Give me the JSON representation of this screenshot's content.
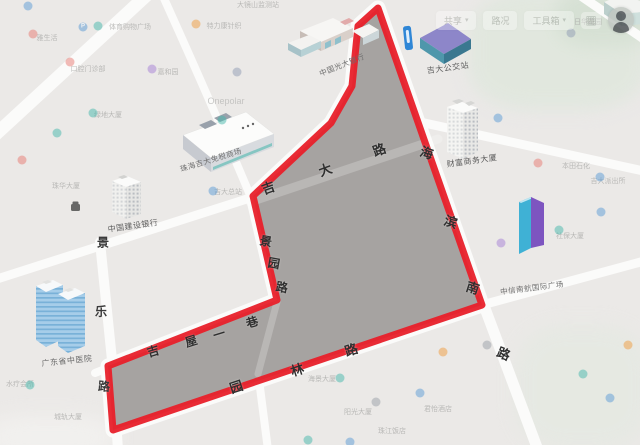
{
  "toolbar": {
    "buttons": [
      {
        "label": "共享",
        "caret": "▾"
      },
      {
        "label": "路况",
        "caret": ""
      },
      {
        "label": "工具箱",
        "caret": "▾"
      }
    ],
    "grid_icon": "▦"
  },
  "map": {
    "background": "#ebe9e7",
    "road_color": "#fbfbfa",
    "boundary_color": "#e8202a",
    "region_fill": "#a6a3a1",
    "boundary_points": "378,8 358,26 352,86 331,123 253,196 277,300 108,366 113,430 482,305",
    "green_patches": [
      {
        "x": 468,
        "y": -10,
        "w": 180,
        "h": 120,
        "c": "#e0e7de",
        "o": 0.9
      },
      {
        "x": 556,
        "y": -12,
        "w": 95,
        "h": 58,
        "c": "#d5e0d3",
        "o": 0.9
      },
      {
        "x": 515,
        "y": 325,
        "w": 135,
        "h": 125,
        "c": "#e5e9e2",
        "o": 0.8
      },
      {
        "x": -15,
        "y": 415,
        "w": 130,
        "h": 45,
        "c": "#f4f3f1",
        "o": 0.7
      }
    ],
    "roads": [
      {
        "d": "M148,-6 L-6,136",
        "w": 13
      },
      {
        "d": "M162,-6 Q210,100 250,195",
        "w": 8
      },
      {
        "d": "M253,197 L-6,280",
        "w": 9
      },
      {
        "d": "M100,242 L112,360 L118,450",
        "w": 10
      },
      {
        "d": "M283,298 L95,373",
        "w": 8
      },
      {
        "d": "M258,372 L268,450",
        "w": 8
      },
      {
        "d": "M482,305 L648,260",
        "w": 9
      },
      {
        "d": "M483,303 L538,450",
        "w": 11
      },
      {
        "d": "M420,122 L648,172",
        "w": 9
      },
      {
        "d": "M578,-6 L648,42",
        "w": 9
      }
    ],
    "interior_roads": [
      {
        "d": "M250,202 L438,139",
        "w": 9
      },
      {
        "d": "M277,302 L258,374",
        "w": 7
      }
    ],
    "streets": [
      {
        "name": "吉大路",
        "size": 13,
        "color": "#2f2f2f",
        "chars": [
          {
            "c": "吉",
            "x": 268,
            "y": 187,
            "r": -20
          },
          {
            "c": "大",
            "x": 325,
            "y": 169,
            "r": -20
          },
          {
            "c": "路",
            "x": 379,
            "y": 149,
            "r": -20
          }
        ]
      },
      {
        "name": "海滨南路",
        "size": 13,
        "color": "#2f2f2f",
        "chars": [
          {
            "c": "海",
            "x": 427,
            "y": 152,
            "r": 18
          },
          {
            "c": "滨",
            "x": 451,
            "y": 221,
            "r": 18
          },
          {
            "c": "南",
            "x": 473,
            "y": 287,
            "r": 18
          },
          {
            "c": "路",
            "x": 504,
            "y": 353,
            "r": 22
          }
        ]
      },
      {
        "name": "景园路",
        "size": 12,
        "color": "#2f2f2f",
        "chars": [
          {
            "c": "景",
            "x": 266,
            "y": 241,
            "r": 10
          },
          {
            "c": "园",
            "x": 274,
            "y": 263,
            "r": 10
          },
          {
            "c": "路",
            "x": 282,
            "y": 287,
            "r": 10
          }
        ]
      },
      {
        "name": "吉屋一巷",
        "size": 12,
        "color": "#2f2f2f",
        "chars": [
          {
            "c": "吉",
            "x": 153,
            "y": 351,
            "r": -17
          },
          {
            "c": "屋",
            "x": 191,
            "y": 341,
            "r": -17
          },
          {
            "c": "一",
            "x": 219,
            "y": 334,
            "r": -17
          },
          {
            "c": "巷",
            "x": 252,
            "y": 322,
            "r": -17
          }
        ]
      },
      {
        "name": "景乐路",
        "size": 12,
        "color": "#3a3a3a",
        "chars": [
          {
            "c": "景",
            "x": 103,
            "y": 242,
            "r": 0
          },
          {
            "c": "乐",
            "x": 101,
            "y": 311,
            "r": 0
          },
          {
            "c": "路",
            "x": 104,
            "y": 386,
            "r": 4
          }
        ]
      },
      {
        "name": "园林路",
        "size": 13,
        "color": "#2f2f2f",
        "chars": [
          {
            "c": "园",
            "x": 236,
            "y": 386,
            "r": -18
          },
          {
            "c": "林",
            "x": 297,
            "y": 369,
            "r": -18
          },
          {
            "c": "路",
            "x": 351,
            "y": 349,
            "r": -18
          }
        ]
      }
    ],
    "poi_labels": [
      {
        "t": "珠海吉大免税商场",
        "x": 211,
        "y": 160,
        "r": -17,
        "s": 7.5,
        "c": "#6e6e6e"
      },
      {
        "t": "中国光大银行",
        "x": 342,
        "y": 65,
        "r": -22,
        "s": 7.5,
        "c": "#6e6e6e"
      },
      {
        "t": "吉大公交站",
        "x": 448,
        "y": 68,
        "r": -8,
        "s": 8,
        "c": "#5f5f5f"
      },
      {
        "t": "财富商务大厦",
        "x": 472,
        "y": 161,
        "r": -8,
        "s": 8,
        "c": "#5a5a5a"
      },
      {
        "t": "中信南航国际广场",
        "x": 532,
        "y": 288,
        "r": -7,
        "s": 7.5,
        "c": "#707070"
      },
      {
        "t": "中国建设银行",
        "x": 133,
        "y": 226,
        "r": -8,
        "s": 8,
        "c": "#5f5f5f"
      },
      {
        "t": "广东省中医院",
        "x": 67,
        "y": 361,
        "r": -6,
        "s": 8,
        "c": "#6a6a6a"
      }
    ],
    "faint_labels": [
      {
        "t": "大镜山监测站",
        "x": 258,
        "y": 5
      },
      {
        "t": "体育购物广场",
        "x": 130,
        "y": 27
      },
      {
        "t": "特力康针织",
        "x": 224,
        "y": 26
      },
      {
        "t": "雅生活",
        "x": 47,
        "y": 38
      },
      {
        "t": "口腔门诊部",
        "x": 88,
        "y": 69
      },
      {
        "t": "嘉和园",
        "x": 168,
        "y": 72
      },
      {
        "t": "绿地大厦",
        "x": 108,
        "y": 115
      },
      {
        "t": "Onepolar",
        "x": 226,
        "y": 101,
        "s": 9,
        "c": "#b8b8b6"
      },
      {
        "t": "珠华大厦",
        "x": 66,
        "y": 186
      },
      {
        "t": "吉大总站",
        "x": 228,
        "y": 192
      },
      {
        "t": "日华花园",
        "x": 588,
        "y": 22
      },
      {
        "t": "本田石化",
        "x": 576,
        "y": 166
      },
      {
        "t": "吉大派出所",
        "x": 608,
        "y": 181
      },
      {
        "t": "社保大厦",
        "x": 570,
        "y": 236
      },
      {
        "t": "海景大厦",
        "x": 322,
        "y": 379
      },
      {
        "t": "阳光大厦",
        "x": 358,
        "y": 412
      },
      {
        "t": "珠江饭店",
        "x": 392,
        "y": 431
      },
      {
        "t": "君怡酒店",
        "x": 438,
        "y": 409
      },
      {
        "t": "水疗会所",
        "x": 20,
        "y": 384
      },
      {
        "t": "城轨大厦",
        "x": 68,
        "y": 417
      }
    ],
    "icons": [
      {
        "x": 28,
        "y": 6,
        "c": "#5b9bd5"
      },
      {
        "x": 83,
        "y": 27,
        "c": "#5b9bd5",
        "g": "P"
      },
      {
        "x": 98,
        "y": 26,
        "c": "#45b8ac"
      },
      {
        "x": 196,
        "y": 24,
        "c": "#f09b3e"
      },
      {
        "x": 33,
        "y": 34,
        "c": "#e87a72"
      },
      {
        "x": 70,
        "y": 62,
        "c": "#e87a72"
      },
      {
        "x": 152,
        "y": 69,
        "c": "#a57fd6"
      },
      {
        "x": 93,
        "y": 113,
        "c": "#45b8ac"
      },
      {
        "x": 57,
        "y": 133,
        "c": "#45b8ac"
      },
      {
        "x": 22,
        "y": 160,
        "c": "#e87a72"
      },
      {
        "x": 213,
        "y": 191,
        "c": "#5b9bd5"
      },
      {
        "x": 237,
        "y": 72,
        "c": "#8f9bb3"
      },
      {
        "x": 222,
        "y": 120,
        "c": "#45b8ac"
      },
      {
        "x": 498,
        "y": 118,
        "c": "#5b9bd5"
      },
      {
        "x": 571,
        "y": 33,
        "c": "#8f9bb3"
      },
      {
        "x": 538,
        "y": 163,
        "c": "#e87a72"
      },
      {
        "x": 559,
        "y": 230,
        "c": "#45b8ac"
      },
      {
        "x": 601,
        "y": 212,
        "c": "#5b9bd5"
      },
      {
        "x": 501,
        "y": 243,
        "c": "#a57fd6"
      },
      {
        "x": 600,
        "y": 177,
        "c": "#5b9bd5"
      },
      {
        "x": 443,
        "y": 352,
        "c": "#f09b3e"
      },
      {
        "x": 487,
        "y": 345,
        "c": "#9aa0a8"
      },
      {
        "x": 340,
        "y": 378,
        "c": "#45b8ac"
      },
      {
        "x": 376,
        "y": 402,
        "c": "#9aa0a8"
      },
      {
        "x": 420,
        "y": 393,
        "c": "#5b9bd5"
      },
      {
        "x": 583,
        "y": 374,
        "c": "#45b8ac"
      },
      {
        "x": 610,
        "y": 398,
        "c": "#5b9bd5"
      },
      {
        "x": 628,
        "y": 345,
        "c": "#f09b3e"
      },
      {
        "x": 30,
        "y": 385,
        "c": "#45b8ac"
      },
      {
        "x": 308,
        "y": 440,
        "c": "#45b8ac"
      },
      {
        "x": 350,
        "y": 442,
        "c": "#5b9bd5"
      }
    ]
  }
}
